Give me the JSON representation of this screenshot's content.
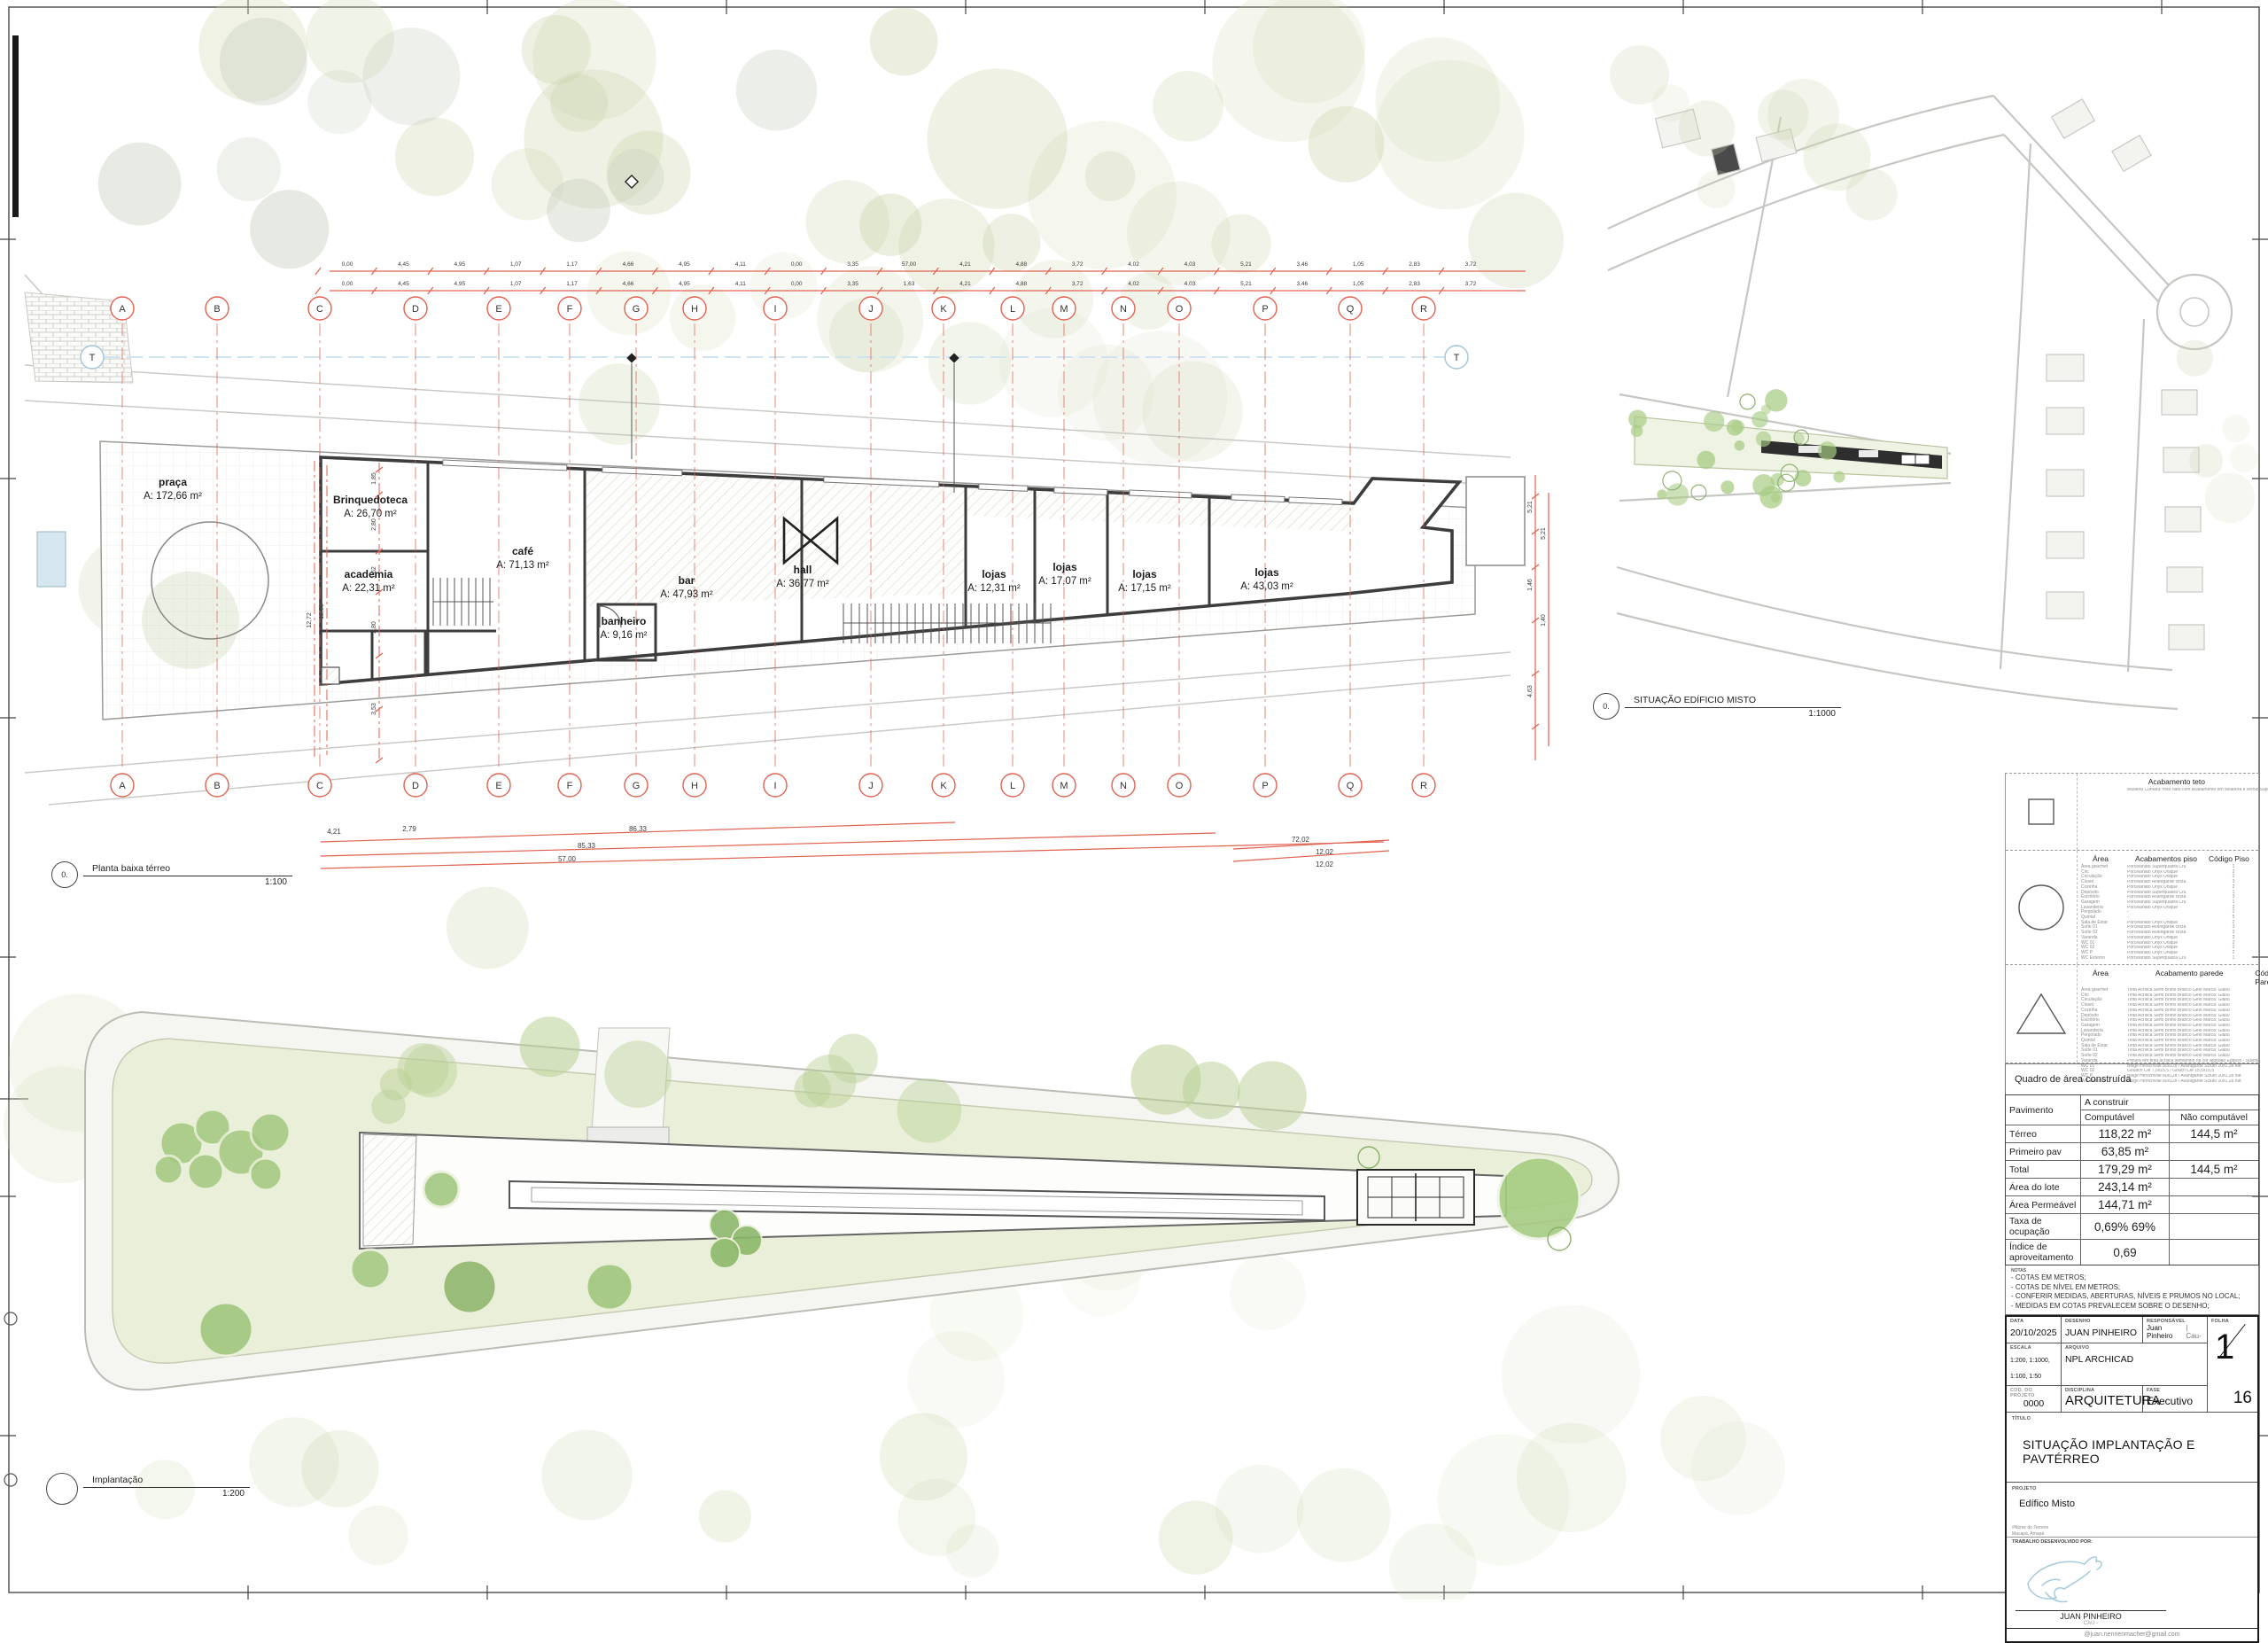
{
  "views": {
    "planta": {
      "bubble": "0.",
      "label": "Planta baixa térreo",
      "scale": "1:100"
    },
    "situacao": {
      "bubble": "0.",
      "label": "SITUAÇÃO EDÍFICIO MISTO",
      "scale": "1:1000"
    },
    "implantacao": {
      "bubble": "",
      "label": "Implantação",
      "scale": "1:200"
    }
  },
  "plan": {
    "grid_letters": [
      "A",
      "B",
      "C",
      "D",
      "E",
      "F",
      "G",
      "H",
      "I",
      "J",
      "K",
      "L",
      "M",
      "N",
      "O",
      "P",
      "Q",
      "R"
    ],
    "section_marker": "T",
    "rooms": [
      {
        "name": "praça",
        "area": "A: 172,66 m²"
      },
      {
        "name": "Brinquedoteca",
        "area": "A: 26,70 m²"
      },
      {
        "name": "academia",
        "area": "A: 22,31 m²"
      },
      {
        "name": "café",
        "area": "A: 71,13 m²"
      },
      {
        "name": "bar",
        "area": "A: 47,93 m²"
      },
      {
        "name": "banheiro",
        "area": "A: 9,16 m²"
      },
      {
        "name": "hall",
        "area": "A: 36,77 m²"
      },
      {
        "name": "lojas",
        "area": "A: 12,31 m²"
      },
      {
        "name": "lojas",
        "area": "A: 17,07 m²"
      },
      {
        "name": "lojas",
        "area": "A: 17,15 m²"
      },
      {
        "name": "lojas",
        "area": "A: 43,03 m²"
      }
    ],
    "dims_top1": [
      "0,00",
      "4,45",
      "4,95",
      "1,07",
      "1,17",
      "4,66",
      "4,95",
      "4,11",
      "0,00",
      "3,35",
      "57,00",
      "4,21",
      "4,88",
      "3,72",
      "4,02",
      "4,03",
      "5,21",
      "3,46",
      "1,05",
      "2,83",
      "3,72"
    ],
    "dims_top2": [
      "0,00",
      "4,45",
      "4,95",
      "1,07",
      "1,17",
      "4,66",
      "4,95",
      "4,11",
      "0,00",
      "3,35",
      "1,63",
      "4,21",
      "4,88",
      "3,72",
      "4,02",
      "4,03",
      "5,21",
      "3,46",
      "1,05",
      "2,83",
      "3,72"
    ],
    "dims_bottom": [
      "4,21",
      "2,79",
      "86,33",
      "85,33",
      "57,00",
      "72,02",
      "12,02",
      "12,02"
    ],
    "dims_left": [
      "1,85",
      "2,80",
      "1,62",
      "2,80",
      "3,53",
      "12,72",
      "12,60"
    ],
    "dims_right": [
      "5,21",
      "5,21",
      "1,46",
      "1,40",
      "4,63"
    ]
  },
  "legend": {
    "teto": {
      "header_finish": "Acabamento teto",
      "header_code": "Código Teto",
      "rows": [
        [
          "",
          "Madeira Cumaru: friso nato com acabamento em seladora e verniz Superlack",
          "1"
        ]
      ]
    },
    "piso": {
      "header_area": "Área",
      "header_finish": "Acabamentos piso",
      "header_code": "Código Piso",
      "rows": [
        [
          "Área gourmet",
          "Porcelanato Superquadra Cru",
          "1"
        ],
        [
          "Circ",
          "Porcelanato Onyx Unique",
          "2"
        ],
        [
          "Circulação",
          "Porcelanato Onyx Unique",
          "2"
        ],
        [
          "Closet",
          "Porcelanato Avantgarde cinza",
          "3"
        ],
        [
          "Cozinha",
          "Porcelanato Onyx Unique",
          "2"
        ],
        [
          "Depósito",
          "Porcelanato Superquadra Cru",
          "1"
        ],
        [
          "Escritório",
          "Porcelanato Avantgarde cinza",
          "3"
        ],
        [
          "Garagem",
          "Porcelanato Superquadra Cru",
          "1"
        ],
        [
          "Lavanderia",
          "Porcelanato Onyx Unique",
          "2"
        ],
        [
          "Pergolado",
          "-",
          "2"
        ],
        [
          "Quintal",
          "-",
          "5"
        ],
        [
          "Sala de Estar",
          "Porcelanato Onyx Unique",
          "2"
        ],
        [
          "Suíte 01",
          "Porcelanato Avantgarde cinza",
          "3"
        ],
        [
          "Suíte 02",
          "Porcelanato Avantgarde cinza",
          "3"
        ],
        [
          "Varanda",
          "Porcelanato Onyx Unique",
          "2"
        ],
        [
          "WC 01",
          "Porcelanato Onyx Unique",
          "2"
        ],
        [
          "WC 02",
          "Porcelanato Onyx Unique",
          "2"
        ],
        [
          "WC P",
          "Porcelanato Onyx Unique",
          "2"
        ],
        [
          "WC Externo",
          "Porcelanato Superquadra Cru",
          "1"
        ]
      ]
    },
    "parede": {
      "header_area": "Área",
      "header_finish": "Acabamento parede",
      "header_code": "Código Parede",
      "rows": [
        [
          "Área gourmet",
          "Tinta Acrílica Semi Brilho Branco Gelo Marca: Glasu",
          "1"
        ],
        [
          "Circ",
          "Tinta Acrílica Semi Brilho Branco Gelo Marca: Glasu",
          "1"
        ],
        [
          "Circulação",
          "Tinta Acrílica Semi Brilho Branco Gelo Marca: Glasu",
          "1"
        ],
        [
          "Closet",
          "Tinta Acrílica Semi Brilho Branco Gelo Marca: Glasu",
          "1"
        ],
        [
          "Cozinha",
          "Tinta Acrílica Semi Brilho Branco Gelo Marca: Glasu",
          "1"
        ],
        [
          "Depósito",
          "Tinta Acrílica Semi Brilho Branco Gelo Marca: Glasu",
          "1"
        ],
        [
          "Escritório",
          "Tinta Acrílica Semi Brilho Branco Gelo Marca: Glasu",
          "1"
        ],
        [
          "Garagem",
          "Tinta Acrílica Semi Brilho Branco Gelo Marca: Glasu",
          "1"
        ],
        [
          "Lavanderia",
          "Tinta Acrílica Semi Brilho Branco Gelo Marca: Glasu",
          "1"
        ],
        [
          "Pergolado",
          "Tinta Acrílica Semi Brilho Branco Gelo Marca: Glasu",
          "1"
        ],
        [
          "Quintal",
          "Tinta Acrílica Semi Brilho Branco Gelo Marca: Glasu",
          "1"
        ],
        [
          "Sala de Estar",
          "Tinta Acrílica Semi Brilho Branco Gelo Marca: Glasu",
          "1"
        ],
        [
          "Suíte 01",
          "Tinta Acrílica Semi Brilho Branco Gelo Marca: Glasu",
          "1"
        ],
        [
          "Suíte 02",
          "Tinta Acrílica Semi Brilho Branco Gelo Marca: Glasu",
          "1"
        ],
        [
          "Varanda",
          "Pintura em tinta acrílica semibrilho na cor Algodão Egípcio - Suvinil",
          "6"
        ],
        [
          "WC 01",
          "Beige Herschville 80x128 / Avantgarde Scluto 20x1,28 nat",
          "3"
        ],
        [
          "WC 02",
          "Gouach Clé 7,5x15,5 / Gouch Clé 15,5x15,5",
          "4"
        ],
        [
          "WC P",
          "Beige Herschville 80x128 / Avantgarde Scluto 20x1,28 nat",
          "3"
        ],
        [
          "WC Externo",
          "Beige Herschville 80x128 / Avantgarde Scluto 20x1,28 nat",
          "3"
        ]
      ]
    }
  },
  "area_table": {
    "title": "Quadro de área construída",
    "col_pavimento": "Pavimento",
    "col_a_construir": "A construir",
    "col_computavel": "Computável",
    "col_nao_computavel": "Não computável",
    "rows": [
      {
        "label": "Térreo",
        "comp": "118,22 m²",
        "nao": "144,5 m²"
      },
      {
        "label": "Primeiro pav",
        "comp": "63,85 m²",
        "nao": ""
      },
      {
        "label": "Total",
        "comp": "179,29 m²",
        "nao": "144,5 m²"
      },
      {
        "label": "Área do lote",
        "comp": "243,14 m²",
        "nao": ""
      },
      {
        "label": "Área Permeável",
        "comp": "144,71 m²",
        "nao": ""
      },
      {
        "label": "Taxa de ocupação",
        "comp": "0,69% 69%",
        "nao": ""
      },
      {
        "label": "Índice de aproveitamento",
        "comp": "0,69",
        "nao": ""
      }
    ]
  },
  "notes": {
    "title": "NOTAS",
    "items": [
      "- COTAS EM METROS;",
      "- COTAS DE NÍVEL EM METROS;",
      "- CONFERIR MEDIDAS, ABERTURAS, NÍVEIS E PRUMOS NO LOCAL;",
      "- MEDIDAS EM COTAS PREVALECEM SOBRE O DESENHO;"
    ]
  },
  "titleblock": {
    "data_label": "DATA",
    "data": "20/10/2025",
    "desenho_label": "DESENHO",
    "desenho": "JUAN PINHEIRO",
    "responsavel_label": "RESPONSÁVEL",
    "responsavel": "Juan Pinheiro",
    "cau": "| Cau-",
    "folha_label": "FOLHA",
    "folha_num": "1",
    "folha_total": "16",
    "escala_label": "ESCALA",
    "escala": "1:200, 1:1000, 1:100, 1:50",
    "arquivo_label": "ARQUIVO",
    "arquivo": "NPL ARCHICAD",
    "cod_label": "COD. DO PROJETO",
    "cod": "0000",
    "disciplina_label": "DISCIPLINA",
    "disciplina": "ARQUITETURA",
    "fase_label": "FASE",
    "fase": "Executivo",
    "titulo_label": "TÍTULO",
    "titulo": "SITUAÇÃO IMPLANTAÇÃO E PAVTÉRREO",
    "projeto_label": "PROJETO",
    "projeto": "Edífico Misto",
    "terreno_line1": "#Nome do Terreno",
    "terreno_line2": "Macapá, Amapá",
    "trabalho_label": "TRABALHO DESENVOLVIDO POR:",
    "autor": "JUAN PINHEIRO",
    "autor_sub": "CAU -",
    "email": "@juan.nennenmacher@gmail.com"
  },
  "colors": {
    "grid_red": "#e0614f",
    "tree_green": "#a9cc85",
    "field_green": "#e9efd8",
    "water_blue": "#cfe6f2",
    "section_blue": "#9fc4d8",
    "wall": "#3d3d3d"
  }
}
